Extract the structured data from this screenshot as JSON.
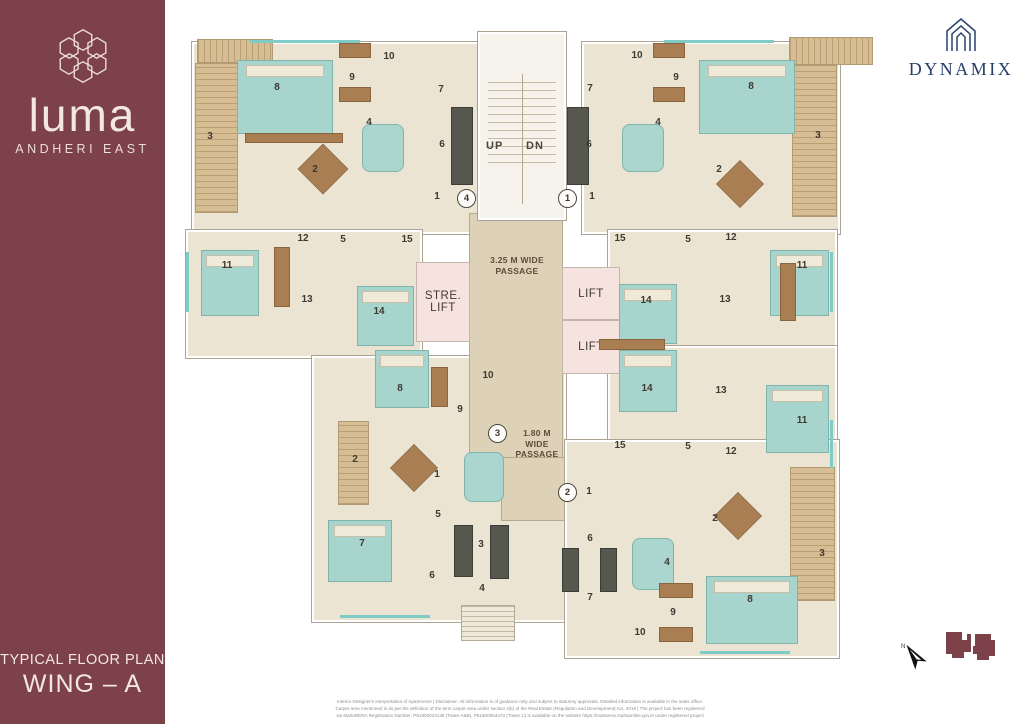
{
  "sidebar": {
    "brand": "luma",
    "location": "ANDHERI EAST",
    "plan_title": "TYPICAL FLOOR PLAN",
    "wing": "WING – A",
    "bg_color": "#7d4149"
  },
  "developer": {
    "name": "DYNAMIX",
    "color": "#27406b"
  },
  "plan": {
    "stair_up": "UP",
    "stair_dn": "DN",
    "stretcher_lift": "STRE. LIFT",
    "lift": "LIFT",
    "passage_main": "3.25 M WIDE PASSAGE",
    "passage_secondary": "1.80 M WIDE PASSAGE",
    "unit_markers": [
      {
        "n": "4",
        "x": 466,
        "y": 198
      },
      {
        "n": "1",
        "x": 567,
        "y": 198
      },
      {
        "n": "3",
        "x": 497,
        "y": 433
      },
      {
        "n": "2",
        "x": 567,
        "y": 492
      }
    ],
    "rooms": [
      {
        "n": "3",
        "x": 210,
        "y": 137
      },
      {
        "n": "8",
        "x": 277,
        "y": 88
      },
      {
        "n": "9",
        "x": 352,
        "y": 78
      },
      {
        "n": "10",
        "x": 389,
        "y": 57
      },
      {
        "n": "7",
        "x": 441,
        "y": 90
      },
      {
        "n": "4",
        "x": 369,
        "y": 123
      },
      {
        "n": "6",
        "x": 442,
        "y": 145
      },
      {
        "n": "2",
        "x": 315,
        "y": 170
      },
      {
        "n": "1",
        "x": 437,
        "y": 197
      },
      {
        "n": "12",
        "x": 303,
        "y": 239
      },
      {
        "n": "5",
        "x": 343,
        "y": 240
      },
      {
        "n": "15",
        "x": 407,
        "y": 240
      },
      {
        "n": "11",
        "x": 227,
        "y": 266
      },
      {
        "n": "13",
        "x": 307,
        "y": 300
      },
      {
        "n": "14",
        "x": 379,
        "y": 312
      },
      {
        "n": "10",
        "x": 637,
        "y": 56
      },
      {
        "n": "9",
        "x": 676,
        "y": 78
      },
      {
        "n": "8",
        "x": 751,
        "y": 87
      },
      {
        "n": "7",
        "x": 590,
        "y": 89
      },
      {
        "n": "4",
        "x": 658,
        "y": 123
      },
      {
        "n": "6",
        "x": 589,
        "y": 145
      },
      {
        "n": "2",
        "x": 719,
        "y": 170
      },
      {
        "n": "3",
        "x": 818,
        "y": 136
      },
      {
        "n": "1",
        "x": 592,
        "y": 197
      },
      {
        "n": "15",
        "x": 620,
        "y": 239
      },
      {
        "n": "5",
        "x": 688,
        "y": 240
      },
      {
        "n": "12",
        "x": 731,
        "y": 238
      },
      {
        "n": "11",
        "x": 802,
        "y": 266
      },
      {
        "n": "13",
        "x": 725,
        "y": 300
      },
      {
        "n": "14",
        "x": 646,
        "y": 301
      },
      {
        "n": "8",
        "x": 400,
        "y": 389
      },
      {
        "n": "10",
        "x": 488,
        "y": 376
      },
      {
        "n": "9",
        "x": 460,
        "y": 410
      },
      {
        "n": "2",
        "x": 355,
        "y": 460
      },
      {
        "n": "1",
        "x": 437,
        "y": 475
      },
      {
        "n": "5",
        "x": 438,
        "y": 515
      },
      {
        "n": "7",
        "x": 362,
        "y": 544
      },
      {
        "n": "3",
        "x": 481,
        "y": 545
      },
      {
        "n": "6",
        "x": 432,
        "y": 576
      },
      {
        "n": "4",
        "x": 482,
        "y": 589
      },
      {
        "n": "14",
        "x": 647,
        "y": 389
      },
      {
        "n": "13",
        "x": 721,
        "y": 391
      },
      {
        "n": "11",
        "x": 802,
        "y": 421
      },
      {
        "n": "15",
        "x": 620,
        "y": 446
      },
      {
        "n": "5",
        "x": 688,
        "y": 447
      },
      {
        "n": "12",
        "x": 731,
        "y": 452
      },
      {
        "n": "1",
        "x": 589,
        "y": 492
      },
      {
        "n": "2",
        "x": 715,
        "y": 519
      },
      {
        "n": "6",
        "x": 590,
        "y": 539
      },
      {
        "n": "4",
        "x": 667,
        "y": 563
      },
      {
        "n": "3",
        "x": 822,
        "y": 554
      },
      {
        "n": "7",
        "x": 590,
        "y": 598
      },
      {
        "n": "9",
        "x": 673,
        "y": 613
      },
      {
        "n": "10",
        "x": 640,
        "y": 633
      },
      {
        "n": "8",
        "x": 750,
        "y": 600
      }
    ]
  },
  "footer": {
    "disclaimer_lines": [
      "Interior Designer's interpretation of Apartments | Disclaimer: All information is of guidance only and subject to statutory approvals. Detailed information is available in the sales office.",
      "Carpet area mentioned is as per the definition of the term carpet area under section 2(k) of the Real Estate (Regulation and Development) Act, 2016 | The project has been registered",
      "via MahaRERA Registration Number: P51800023138 (Tower A&B), P51800054473 (Tower C) is available on the website https://maharera.mahaonline.gov.in under registered project"
    ]
  },
  "colors": {
    "sidebar_maroon": "#7d4149",
    "developer_navy": "#27406b",
    "floor_cream": "#ece4d3",
    "passage_beige": "#ddd2b7",
    "lift_pink": "#f6e2de",
    "bedroom_teal": "#a7d4cd",
    "balcony_wood": "#d7bd93",
    "kitchen_dark": "#56574e"
  }
}
